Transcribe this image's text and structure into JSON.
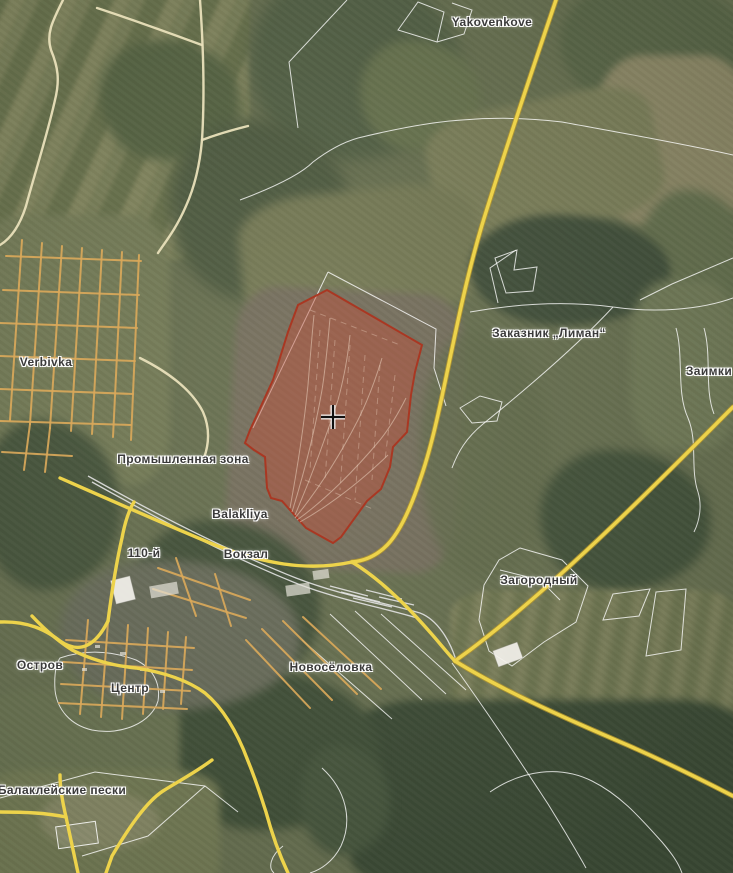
{
  "labels": {
    "yakovenkove": {
      "text": "Yakovenkove"
    },
    "verbivka": {
      "text": "Verbivka"
    },
    "prom_zona": {
      "text": "Промышленная зона"
    },
    "balakliya": {
      "text": "Balakliya"
    },
    "vokzal": {
      "text": "Вокзал"
    },
    "km110": {
      "text": "110-й"
    },
    "zakaznik_liman": {
      "text": "Заказник „Лиман“"
    },
    "zaimki": {
      "text": "Заимки"
    },
    "zagorodny": {
      "text": "Загородный"
    },
    "novoselovka": {
      "text": "Новосёловка"
    },
    "ostrov": {
      "text": "Остров"
    },
    "centr": {
      "text": "Центр"
    },
    "balakleyskie_peski": {
      "text": "Балаклейские пески"
    }
  },
  "colors": {
    "highlight_fill": "#c0503a",
    "highlight_stroke": "#ab3520",
    "road_major": "#edd34b",
    "road_casing": "#b1952f",
    "road_minor": "#d9a85a",
    "road_pale": "#e9e0bb",
    "field_boundary": "#ffffff",
    "railway": "#e3e3e3",
    "label_text": "#3a3a3a",
    "label_halo": "#ffffff"
  }
}
